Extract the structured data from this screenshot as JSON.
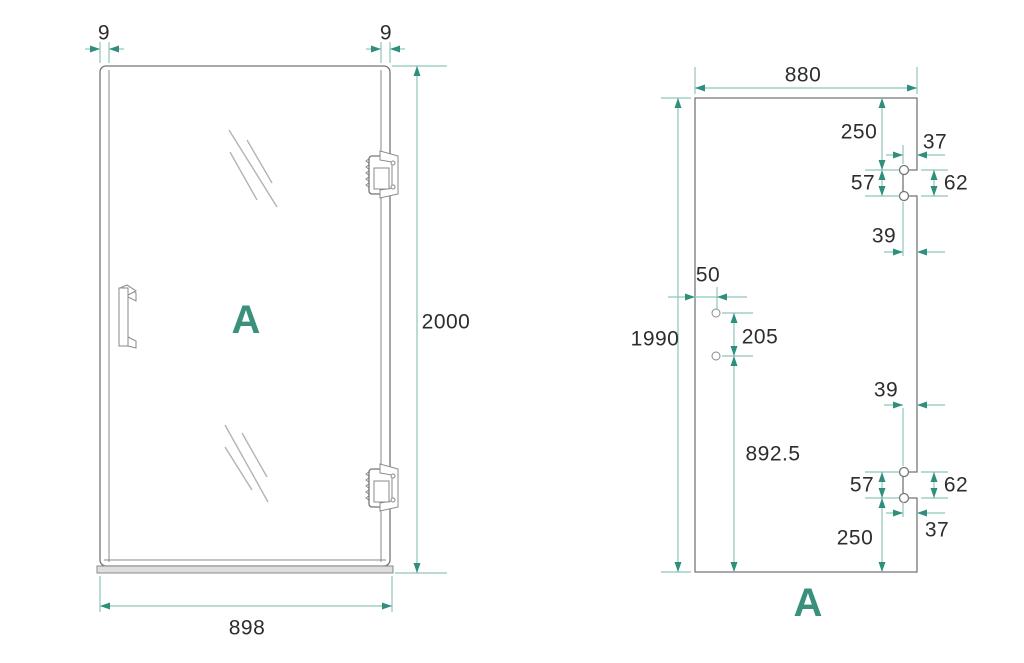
{
  "document": {
    "type": "shower-door-technical-drawing",
    "background": "#ffffff"
  },
  "colors": {
    "accent": "#3a8f7d",
    "dimension_line": "#8ec6b8",
    "arrow": "#2f8e7c",
    "outline": "#757575",
    "text": "#2d2d2d"
  },
  "view_front": {
    "label": "A",
    "dims": {
      "frame_left": "9",
      "frame_right": "9",
      "height": "2000",
      "width": "898"
    }
  },
  "view_glass": {
    "label": "A",
    "dims": {
      "width": "880",
      "height": "1990",
      "top_hinge_from_top": "250",
      "top_hinge_inset": "37",
      "top_hinge_pitch": "57",
      "top_hinge_cutout": "62",
      "top_hinge_center_inset": "39",
      "handle_from_edge": "50",
      "handle_hole_pitch": "205",
      "handle_from_bottom": "892.5",
      "bottom_hinge_center_inset": "39",
      "bottom_hinge_pitch": "57",
      "bottom_hinge_cutout": "62",
      "bottom_hinge_inset": "37",
      "bottom_hinge_from_bottom": "250"
    }
  }
}
